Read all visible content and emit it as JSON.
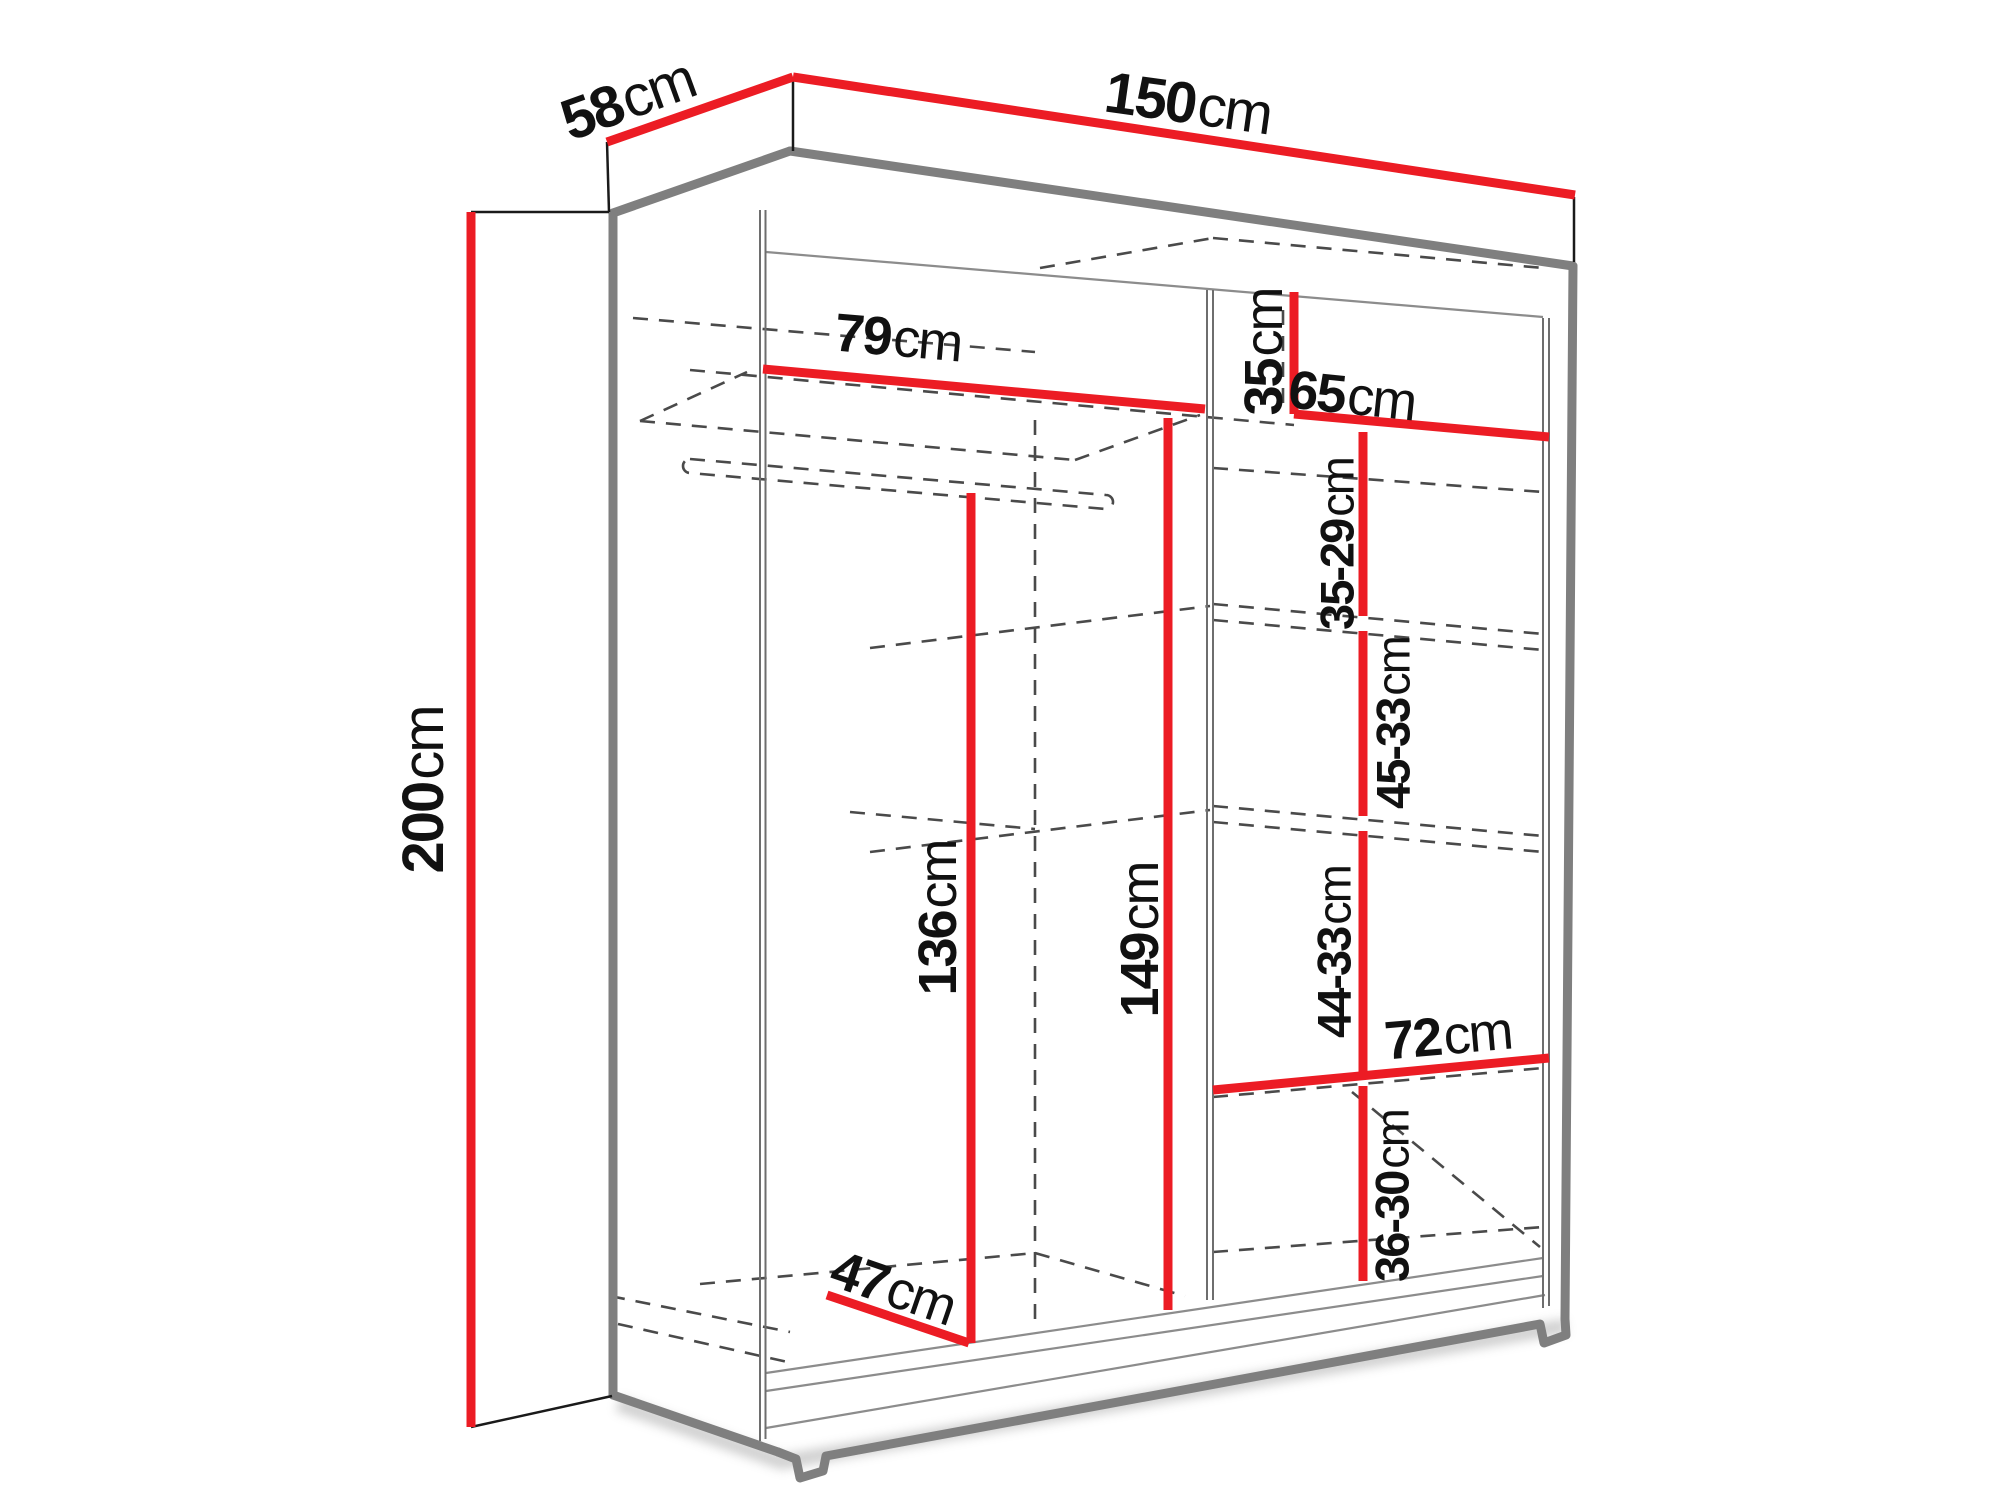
{
  "diagram": {
    "type": "furniture-dimension-diagram",
    "subject": "sliding-door wardrobe line drawing",
    "units": "cm"
  },
  "colors": {
    "dimension_red": "#EC1C24",
    "edge_gray": "#7F7F7F",
    "line_dark": "#1A1A1A",
    "thin_gray": "#8C8C8C",
    "hidden_dash": "#4A4A4A",
    "background": "#FFFFFF"
  },
  "dimensions": [
    {
      "id": "depth-top",
      "num": "58",
      "unit": "cm"
    },
    {
      "id": "width-total",
      "num": "150",
      "unit": "cm"
    },
    {
      "id": "height-total",
      "num": "200",
      "unit": "cm"
    },
    {
      "id": "left-section-width",
      "num": "79",
      "unit": "cm"
    },
    {
      "id": "top-compartment-height",
      "num": "35",
      "unit": "cm"
    },
    {
      "id": "right-section-width",
      "num": "65",
      "unit": "cm"
    },
    {
      "id": "shelf-gap-upper",
      "num": "35-29",
      "unit": "cm"
    },
    {
      "id": "shelf-gap-middle",
      "num": "45-33",
      "unit": "cm"
    },
    {
      "id": "hanging-space-height",
      "num": "136",
      "unit": "cm"
    },
    {
      "id": "interior-height",
      "num": "149",
      "unit": "cm"
    },
    {
      "id": "shelf-gap-lower",
      "num": "44-33",
      "unit": "cm"
    },
    {
      "id": "bottom-shelf-width",
      "num": "72",
      "unit": "cm"
    },
    {
      "id": "bottom-compartment-height",
      "num": "36-30",
      "unit": "cm"
    },
    {
      "id": "interior-depth",
      "num": "47",
      "unit": "cm"
    }
  ]
}
